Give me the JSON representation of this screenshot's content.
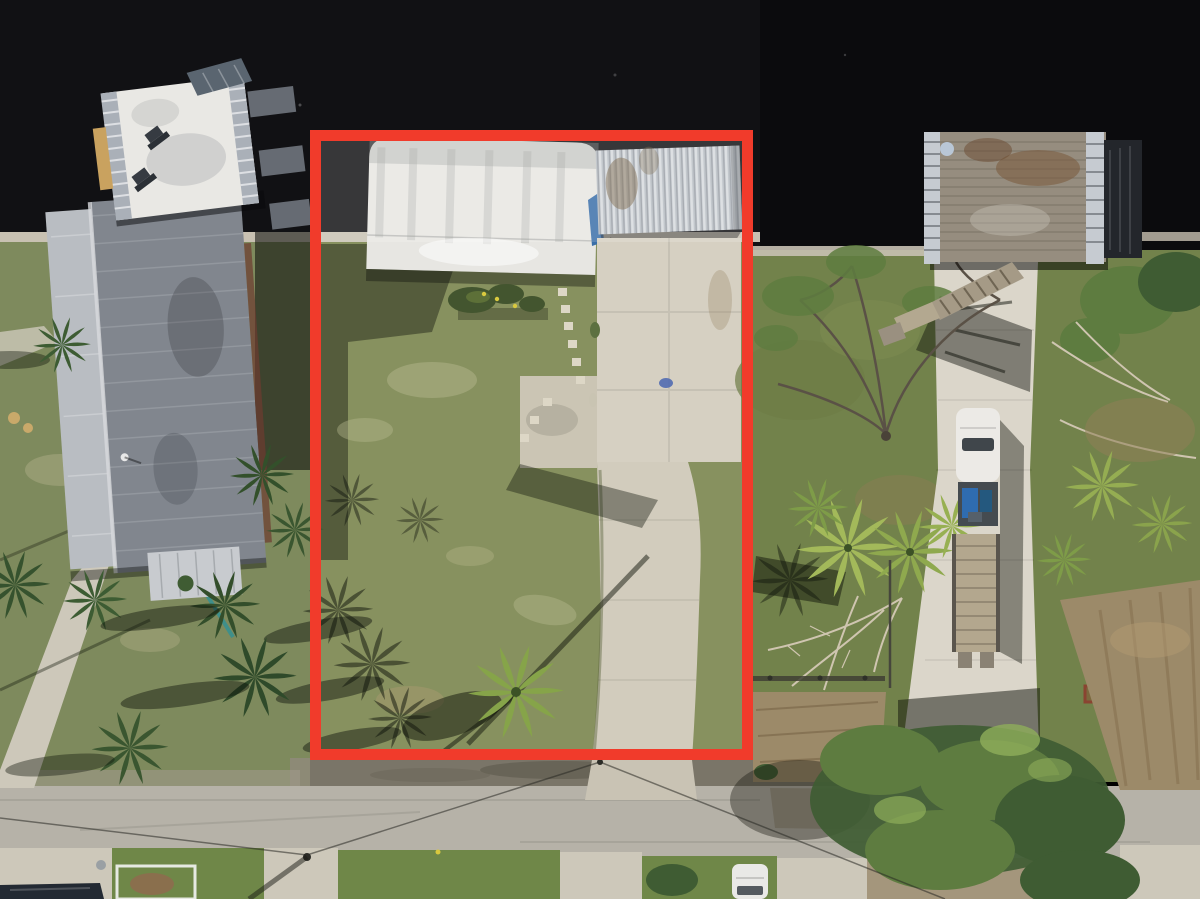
{
  "meta": {
    "type": "aerial-drone-photograph",
    "orientation": "top-down",
    "subject": "vacant waterfront lot outlined with red property-boundary rectangle"
  },
  "annotation": {
    "label": "property-boundary-outline",
    "shape": "rectangle",
    "color": "#f13b2b",
    "stroke_px": 11
  },
  "colors": {
    "water": "#111114",
    "seawall": "#c8c1b2",
    "grassLot": "#87915f",
    "grassLeft": "#7e8a5d",
    "grassRight": "#72824b",
    "lawn": "#6f8748",
    "road": "#b6b2a8",
    "apron": "#cdc8ba",
    "shoulder": "#8f8a7a",
    "pad": "#d6d0c2",
    "drive": "#d2ccbd",
    "driveRight": "#dbd6ca",
    "barn": "#e7e6e2",
    "carport": "#b7bdc3",
    "tarp": "#3a6ea8",
    "roofMain": "#81868e",
    "roofLight": "#b9bdc2",
    "annex": "#c8cbcf",
    "deckWhite": "#e9e8e4",
    "louver": "#aab0b8",
    "solar": "#5a6570",
    "wood": "#968d7f",
    "ramp": "#a59a86",
    "dirt": "#9c8a69",
    "canopy": "#5e7c40",
    "canopyDark": "#3f5c33",
    "palmDark": "#3d5c33",
    "palmBright": "#97b052",
    "branch": "#5a5146",
    "deadBranch": "#cfc5b0",
    "truck": "#eceae6",
    "bed": "#454b50",
    "trailer": "#b3a78e",
    "carDark": "#232a33",
    "carWhite": "#e9e9e6",
    "red": "#f13b2b",
    "stone": "#ddd7c6",
    "fence": "#e6e9e2",
    "teal": "#3f8f8a"
  },
  "objects": {
    "water": "dark canal water along top",
    "outlined_lot": "grass lot with quonset barn, carport, concrete pad and driveway",
    "barn": "white curved-roof metal barn",
    "carport": "corrugated metal carport with blue tarp edge",
    "left_house": "gray standing-seam roof house with white rooftop deck and two lounge chairs",
    "rooftop_deck_items": [
      "two lounge chairs",
      "solar panel",
      "louvered railings"
    ],
    "right_parcel": "treed lot with concrete driveway, white pickup truck towing flatbed trailer",
    "dock": "weathered wooden dock deck with ramp and satellite dish",
    "road": "concrete street across bottom with power lines",
    "vehicles": [
      "white pickup truck",
      "flatbed trailer",
      "dark car bottom-left",
      "white car bottom-center"
    ],
    "vegetation": [
      "palm trees",
      "bare oak tree",
      "fallen dead tree",
      "large green tree canopy bottom-right"
    ]
  }
}
